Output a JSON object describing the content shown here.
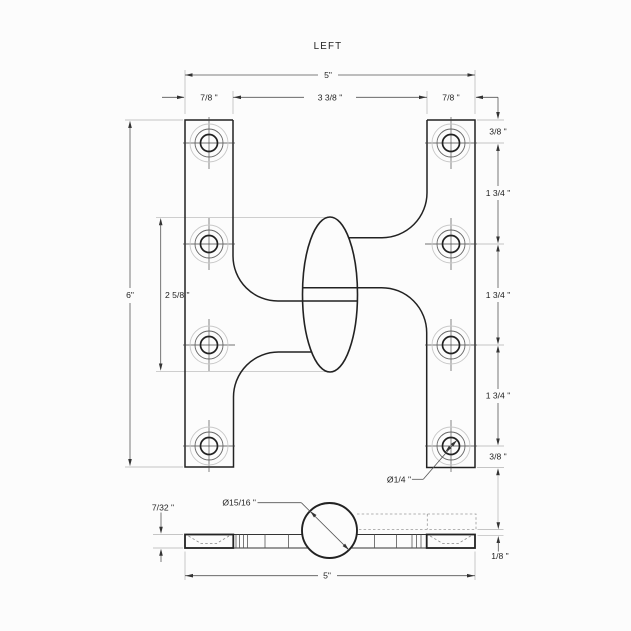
{
  "title": "LEFT",
  "front_view": {
    "overall_width": "5\"",
    "left_leaf_width": "7/8 \"",
    "center_gap": "3 3/8 \"",
    "right_leaf_width": "7/8 \"",
    "leaf_height": "6\"",
    "knuckle_length": "2 5/8 \"",
    "top_edge_to_first_hole": "3/8 \"",
    "hole_spacing_upper": "1 3/4 \"",
    "hole_spacing_middle": "1 3/4 \"",
    "hole_spacing_lower": "1 3/4 \"",
    "last_hole_to_bottom_edge": "3/8 \"",
    "screw_hole_diameter": "Ø1/4 \""
  },
  "side_view": {
    "leaf_thickness": "7/32 \"",
    "knuckle_diameter": "Ø15/16 \"",
    "overall_width": "5\"",
    "leaf_offset_gap": "1/8 \""
  }
}
